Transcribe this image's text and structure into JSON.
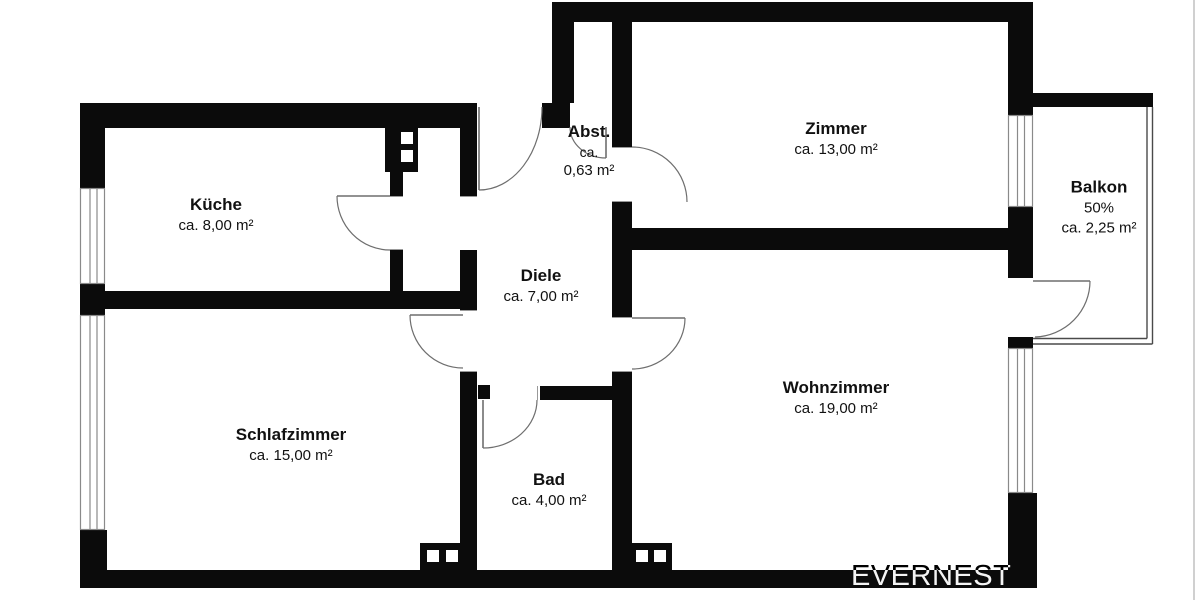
{
  "rooms": {
    "kueche": {
      "name": "Küche",
      "area": "ca. 8,00 m²"
    },
    "abstellraum": {
      "name": "Abst.",
      "area_line1": "ca.",
      "area_line2": "0,63 m²"
    },
    "zimmer": {
      "name": "Zimmer",
      "area": "ca. 13,00 m²"
    },
    "balkon": {
      "name": "Balkon",
      "share": "50%",
      "area": "ca. 2,25 m²"
    },
    "diele": {
      "name": "Diele",
      "area": "ca. 7,00 m²"
    },
    "schlafzimmer": {
      "name": "Schlafzimmer",
      "area": "ca. 15,00 m²"
    },
    "bad": {
      "name": "Bad",
      "area": "ca. 4,00 m²"
    },
    "wohnzimmer": {
      "name": "Wohnzimmer",
      "area": "ca. 19,00 m²"
    }
  },
  "watermark": {
    "brand": "EVERNEST"
  },
  "colors": {
    "wall": "#0b0b0b",
    "background": "#ffffff",
    "door_line": "#6e6e6e",
    "window_frame": "#8a8a8a",
    "railing": "#4a4a4a",
    "label_text": "#111111"
  }
}
